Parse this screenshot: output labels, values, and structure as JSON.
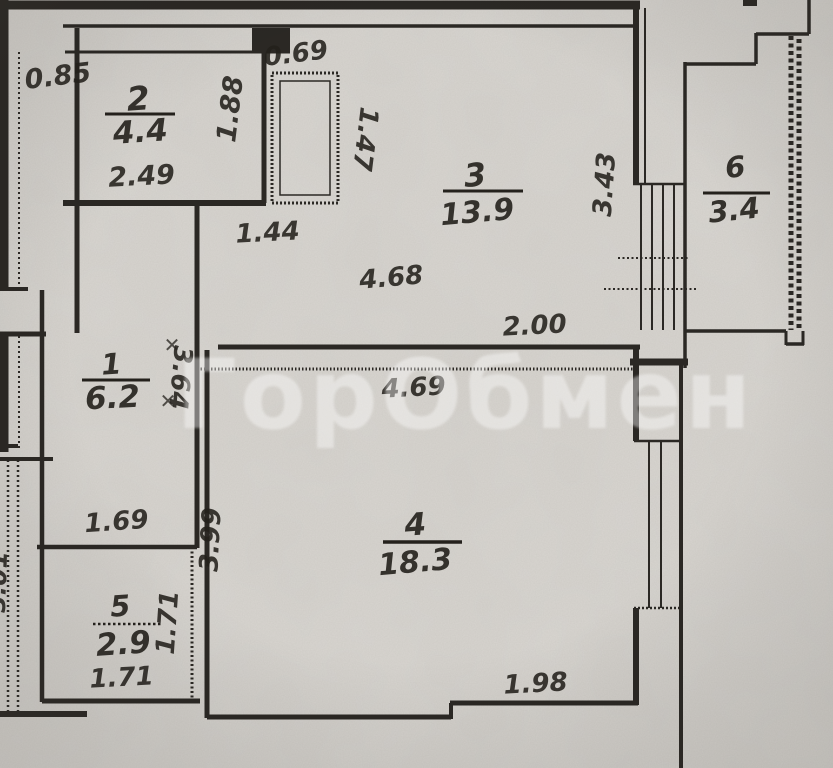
{
  "plan": {
    "watermark": "ГорОбмен",
    "correction_mark": "✕",
    "rooms": {
      "r1": {
        "number": "1",
        "area": "6.2"
      },
      "r2": {
        "number": "2",
        "area": "4.4"
      },
      "r3": {
        "number": "3",
        "area": "13.9"
      },
      "r4": {
        "number": "4",
        "area": "18.3"
      },
      "r5": {
        "number": "5",
        "area": "2.9"
      },
      "r6": {
        "number": "6",
        "area": "3.4"
      }
    },
    "dimensions": {
      "d085": "0.85",
      "d249": "2.49",
      "d188": "1.88",
      "d069": "0.69",
      "d147": "1.47",
      "d144": "1.44",
      "d468": "4.68",
      "d200": "2.00",
      "d343": "3.43",
      "d364": "3.64",
      "d169": "1.69",
      "d469": "4.69",
      "d399": "3.99",
      "d198": "1.98",
      "d171v": "1.71",
      "d171h": "1.71",
      "d301": "3.01"
    },
    "colors": {
      "paper": "#d5d2cd",
      "ink": "#2b2824"
    }
  }
}
